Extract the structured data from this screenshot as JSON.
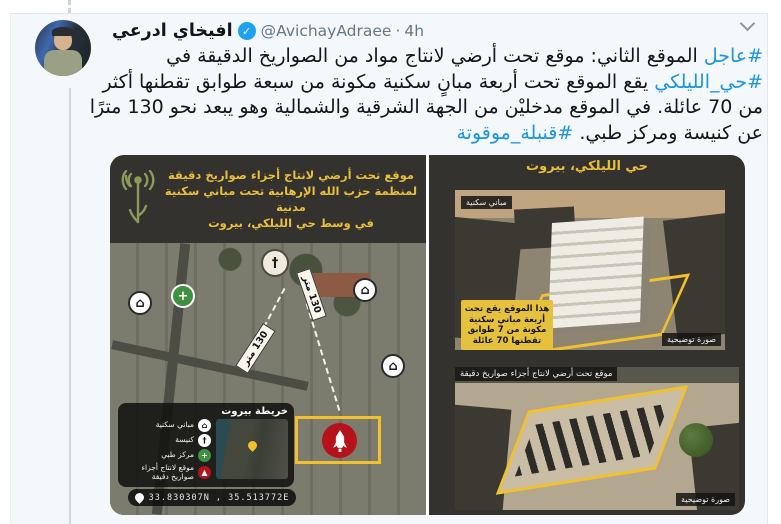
{
  "colors": {
    "link_blue": "#1b95e0",
    "verified_blue": "#1da1f2",
    "surface_gray": "#f5f8fa",
    "highlight_yellow": "#f2c12e",
    "marker_red": "#b5121b",
    "title_yellow": "#e9bf3c"
  },
  "header": {
    "display_name": "افيخاي ادرعي",
    "verified_check": "✓",
    "handle": "@AvichayAdraee",
    "separator": "·",
    "time": "4h"
  },
  "tweet": {
    "hashtag_urgent": "#عاجل",
    "part1": " الموقع الثاني: موقع تحت أرضي لانتاج مواد من الصواريخ الدقيقة في ",
    "hashtag_neighborhood": "#حي_الليلكي",
    "part2": " يقع الموقع تحت أربعة مبانٍ سكنية مكونة من سبعة طوابق تقطنها أكثر من 70 عائلة. في الموقع مدخليْن من الجهة الشرقية والشمالية وهو يبعد نحو 130 مترًا عن كنيسة ومركز طبي. ",
    "hashtag_timebomb": "#قنبلة_موقوتة"
  },
  "left_image": {
    "header_lines": [
      "موقع تحت أرضي لانتاج أجزاء صواريخ دقيقة",
      "لمنظمة حزب الله الإرهابية تحت مباني سكنية مدنية",
      "في وسط حي الليلكي، بيروت"
    ],
    "map_icons": {
      "house_glyph": "⌂",
      "church_glyph": "†",
      "medical_glyph": "+"
    },
    "distance_label_1": "130 متر",
    "distance_label_2": "130 متر",
    "inset": {
      "title": "خريطة بيروت",
      "legend": [
        "مباني سكنية",
        "كنيسة",
        "مركز طبي",
        "موقع لانتاج أجزاء صواريخ دقيقة"
      ],
      "coordinates": "33.830307N , 35.513772E"
    }
  },
  "right_image": {
    "title": "حي الليلكي، بيروت",
    "top_render": {
      "label": "مباني سكنية",
      "callout_lines": [
        "هذا الموقع يقع تحت",
        "أربعة مباني سكنية",
        "مكونة من 7 طوابق",
        "تقطنها 70 عائلة"
      ],
      "caption": "صورة توضيحية"
    },
    "bottom_render": {
      "label": "موقع تحت أرضي لانتاج أجزاء صواريخ دقيقة",
      "caption": "صورة توضيحية"
    }
  }
}
